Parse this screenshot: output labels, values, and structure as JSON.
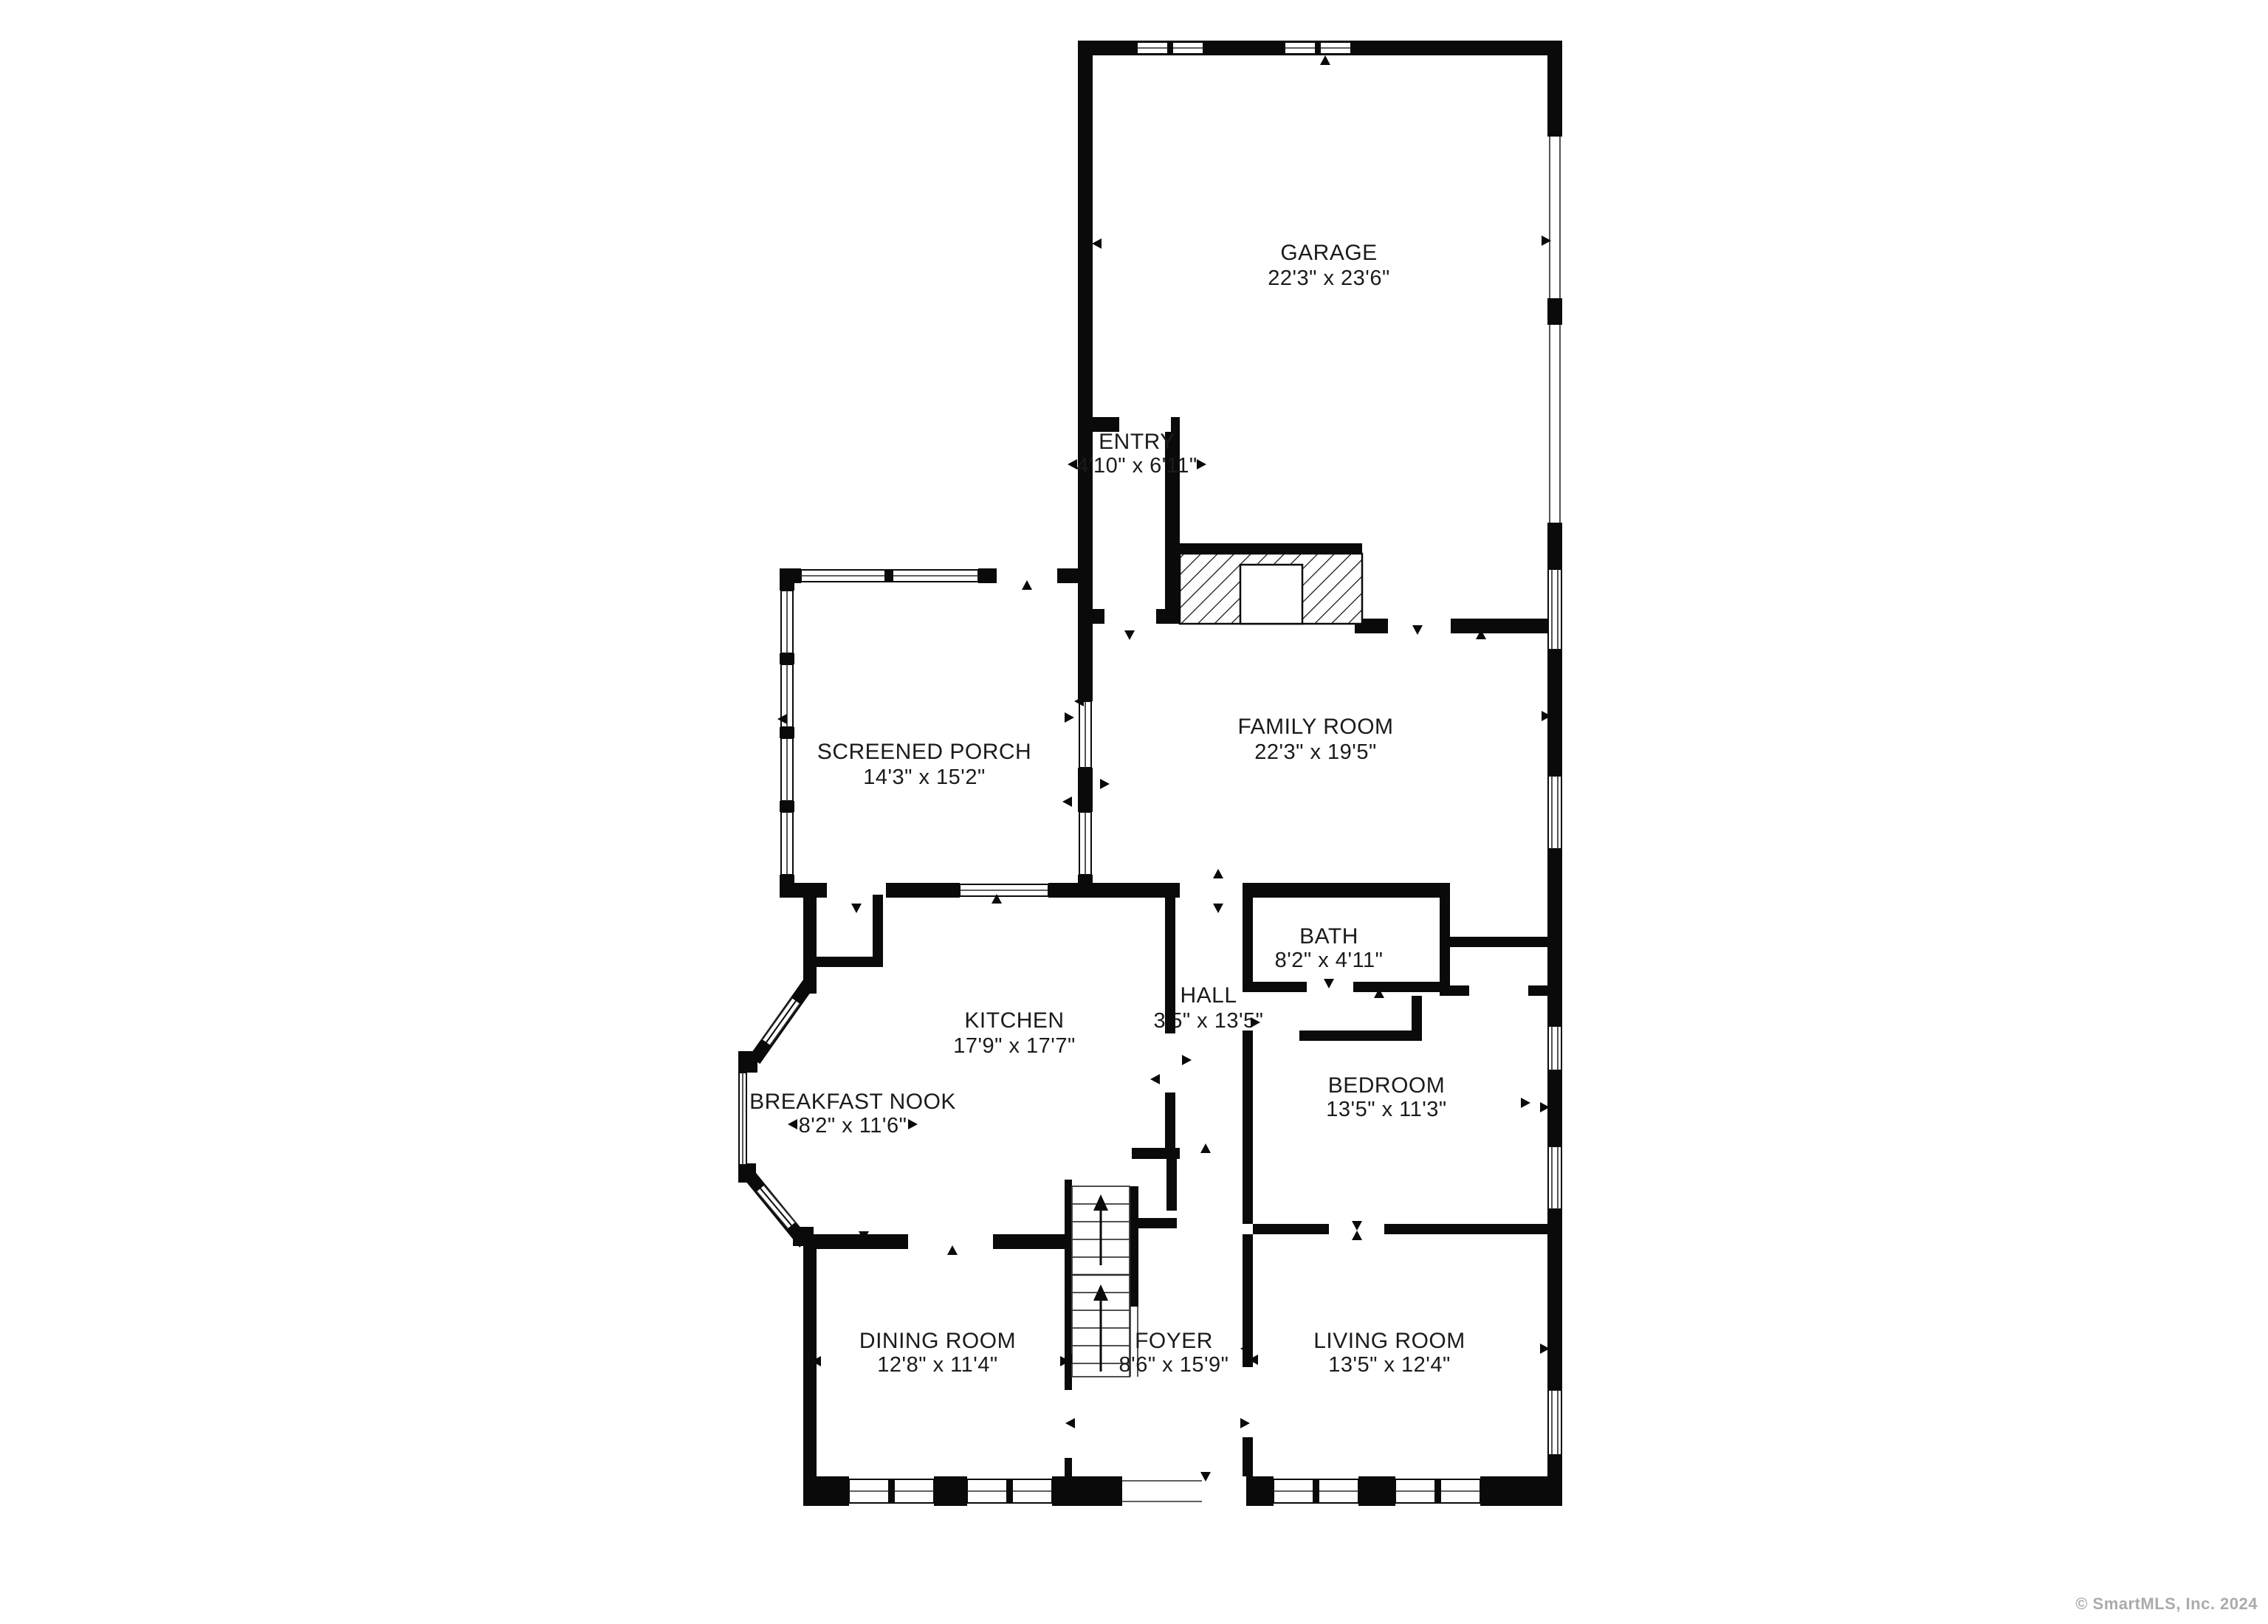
{
  "meta": {
    "type": "residential floor plan",
    "copyright": "© SmartMLS, Inc. 2024"
  },
  "rooms": [
    {
      "id": "garage",
      "name": "GARAGE",
      "dims": "22'3\" x 23'6\""
    },
    {
      "id": "entry",
      "name": "ENTRY",
      "dims": "4'10\" x 6'11\""
    },
    {
      "id": "screened-porch",
      "name": "SCREENED PORCH",
      "dims": "14'3\" x 15'2\""
    },
    {
      "id": "family-room",
      "name": "FAMILY ROOM",
      "dims": "22'3\" x 19'5\""
    },
    {
      "id": "bath",
      "name": "BATH",
      "dims": "8'2\" x 4'11\""
    },
    {
      "id": "hall",
      "name": "HALL",
      "dims": "3'5\" x 13'5\""
    },
    {
      "id": "kitchen",
      "name": "KITCHEN",
      "dims": "17'9\" x 17'7\""
    },
    {
      "id": "bedroom",
      "name": "BEDROOM",
      "dims": "13'5\" x 11'3\""
    },
    {
      "id": "breakfast-nook",
      "name": "BREAKFAST NOOK",
      "dims": "8'2\" x 11'6\""
    },
    {
      "id": "dining-room",
      "name": "DINING ROOM",
      "dims": "12'8\" x 11'4\""
    },
    {
      "id": "foyer",
      "name": "FOYER",
      "dims": "8'6\" x 15'9\""
    },
    {
      "id": "living-room",
      "name": "LIVING ROOM",
      "dims": "13'5\" x 12'4\""
    }
  ]
}
